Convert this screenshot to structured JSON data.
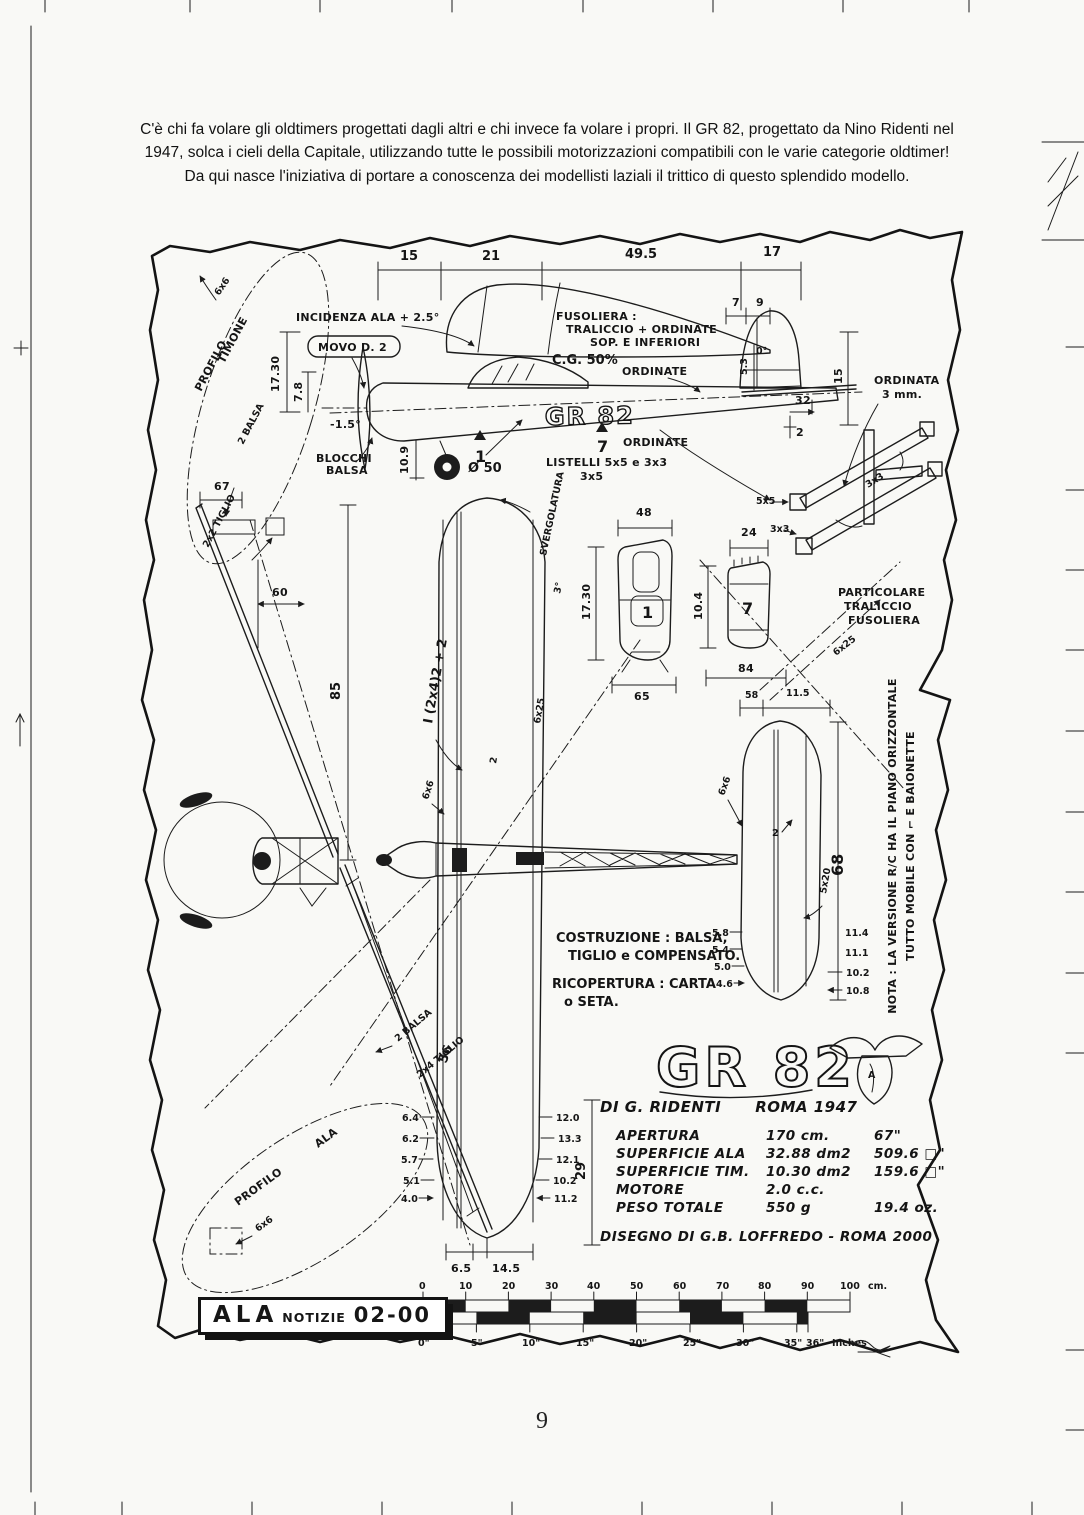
{
  "intro": {
    "lines": [
      "C'è chi fa volare gli oldtimers progettati dagli altri e chi invece fa volare i propri. Il GR 82, progettato da Nino Ridenti nel",
      "1947, solca i cieli della Capitale, utilizzando tutte le possibili motorizzazioni compatibili con le varie categorie oldtimer!",
      "Da qui nasce l'iniziativa di portare a conoscenza dei modellisti laziali il trittico di questo splendido modello."
    ]
  },
  "lab": {
    "d15": "15",
    "d21": "21",
    "d49_5": "49.5",
    "d17": "17",
    "incidenza": "INCIDENZA ALA + 2.5°",
    "movo": "MOVO D. 2",
    "fus1": "FUSOLIERA :",
    "fus2": "TRALICCIO + ORDINATE",
    "fus3": "SOP. E INFERIORI",
    "cg": "C.G. 50%",
    "d7": "7",
    "d9": "9",
    "d0": "0°",
    "ordinate_a": "ORDINATE",
    "ordinate_b": "ORDINATE",
    "d5_3": "5.3",
    "d32": "32",
    "d15v": "15",
    "d2": "2",
    "ordinata1": "ORDINATA",
    "ordinata2": "3 mm.",
    "d17_30": "17.30",
    "d7_8": "7.8",
    "dneg": "-1.5°",
    "d10_9": "10.9",
    "blocchi1": "BLOCCHI",
    "blocchi2": "BALSA",
    "gr82side": "GR 82",
    "listelli1": "LISTELLI  5x5 e 3x3",
    "listelli2": "3x5",
    "wheel": "Ø 50",
    "n1": "1",
    "n7": "7",
    "f1": "1",
    "f7": "7",
    "profilo1": "PROFILO",
    "profilo2": "TIMONE",
    "balsa2a": "2 BALSA",
    "tiglio22": "2x2 TIGLIO",
    "b6x6_tim": "6x6",
    "d67": "67",
    "d85": "85",
    "d60": "60",
    "sverg1": "SVERGOLATURA",
    "sverg2": "3°",
    "spar": "I (2x4)2 + 2",
    "b6x6_wing": "6x6",
    "b6x25_wing": "6x25",
    "rib2": "2",
    "d48": "48",
    "d17_30b": "17.30",
    "d65": "65",
    "d24": "24",
    "d10_4": "10.4",
    "d84": "84",
    "b5x5": "5x5",
    "b3x3a": "3x3",
    "b3x3b": "3x3",
    "b6x25t": "6x25",
    "part1": "PARTICOLARE",
    "part2": "TRALICCIO",
    "part3": "FUSOLIERA",
    "d58": "58",
    "d11_5": "11.5",
    "b6x6_tail": "6x6",
    "t2": "2",
    "t5x20": "5x20",
    "d68": "68",
    "d11_4": "11.4",
    "d11_1": "11.1",
    "d10_2t": "10.2",
    "d10_8": "10.8",
    "tr58": "5.8",
    "tr54": "5.4",
    "tr50": "5.0",
    "tr46": "4.6",
    "costr1": "COSTRUZIONE : BALSA,",
    "costr2": "TIGLIO e COMPENSATO.",
    "ricop1": "RICOPERTURA : CARTA",
    "ricop2": "o SETA.",
    "nota1": "NOTA : LA VERSIONE R/C HA IL PIANO ORIZZONTALE",
    "nota2": "TUTTO MOBILE CON ⌐ E BAIONETTE",
    "d56": "56",
    "d29": "29",
    "balsa2b": "2 BALSA",
    "tiglio24": "2x4 TIGLIO",
    "b6x6_ala": "6x6",
    "wr64": "6.4",
    "wr62": "6.2",
    "wr57": "5.7",
    "wr51": "5.1",
    "wr40": "4.0",
    "wl120": "12.0",
    "wl133": "13.3",
    "wl121": "12.1",
    "wl102": "10.2",
    "wl112": "11.2",
    "d6_5": "6.5",
    "d14_5": "14.5"
  },
  "logo": {
    "text": "GR 82"
  },
  "credits": {
    "author": "DI  G. RIDENTI",
    "year": "ROMA 1947",
    "drawn": "DISEGNO DI G.B. LOFFREDO - ROMA 2000"
  },
  "specs": {
    "rows": [
      {
        "name": "APERTURA",
        "metric": "170 cm.",
        "imperial": "67\""
      },
      {
        "name": "SUPERFICIE ALA",
        "metric": "32.88 dm2",
        "imperial": "509.6 □\""
      },
      {
        "name": "SUPERFICIE TIM.",
        "metric": "10.30 dm2",
        "imperial": "159.6 □\""
      },
      {
        "name": "MOTORE",
        "metric": "2.0 c.c.",
        "imperial": ""
      },
      {
        "name": "PESO TOTALE",
        "metric": "550 g",
        "imperial": "19.4 oz."
      }
    ]
  },
  "box": {
    "w1": "ALA",
    "w2": "NOTIZIE",
    "w3": "02-00"
  },
  "ruler": {
    "cm": [
      "0",
      "10",
      "20",
      "30",
      "40",
      "50",
      "60",
      "70",
      "80",
      "90",
      "100"
    ],
    "cm_unit": "cm.",
    "inches": [
      "0\"",
      "5\"",
      "10\"",
      "15\"",
      "20\"",
      "25\"",
      "30\"",
      "35\"",
      "36\""
    ],
    "in_unit": "Inches"
  },
  "page_number": "9"
}
